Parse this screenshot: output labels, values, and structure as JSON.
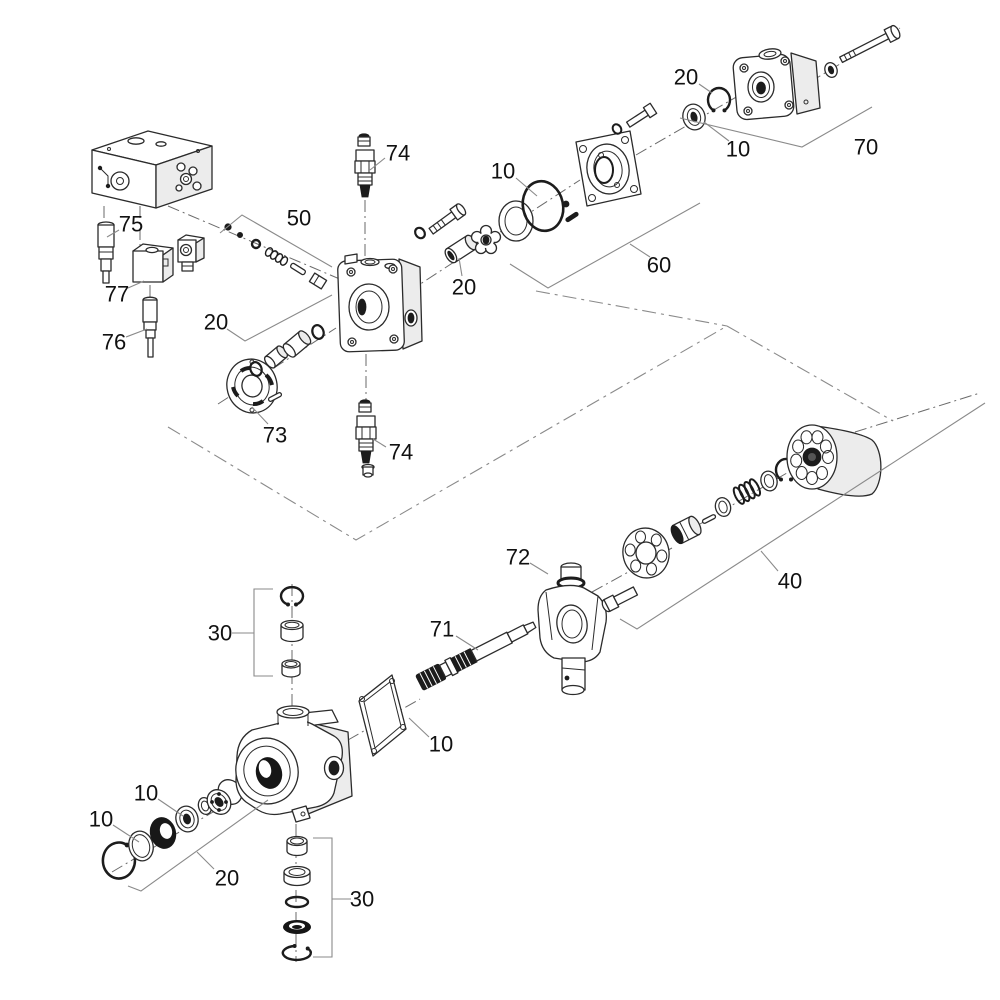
{
  "figure": {
    "type": "exploded-parts-diagram",
    "subject": "hydraulic-piston-pump-assembly",
    "background_color": "#ffffff",
    "line_color": "#2b2b2b",
    "label_color": "#111111",
    "callouts": [
      {
        "ref": "74",
        "x": 398,
        "y": 153,
        "leader": [
          [
            385,
            158
          ],
          [
            370,
            170
          ]
        ]
      },
      {
        "ref": "50",
        "x": 299,
        "y": 218,
        "bracket": [
          [
            220,
            233
          ],
          [
            242,
            215
          ],
          [
            332,
            267
          ]
        ]
      },
      {
        "ref": "75",
        "x": 131,
        "y": 224,
        "leader": [
          [
            119,
            230
          ],
          [
            107,
            237
          ]
        ]
      },
      {
        "ref": "77",
        "x": 117,
        "y": 294,
        "leader": [
          [
            128,
            288
          ],
          [
            144,
            281
          ]
        ]
      },
      {
        "ref": "76",
        "x": 114,
        "y": 342,
        "leader": [
          [
            126,
            337
          ],
          [
            147,
            329
          ]
        ]
      },
      {
        "ref": "20",
        "x": 216,
        "y": 322,
        "bracket": [
          [
            227,
            329
          ],
          [
            245,
            341
          ],
          [
            332,
            295
          ]
        ]
      },
      {
        "ref": "73",
        "x": 275,
        "y": 435,
        "leader": [
          [
            268,
            424
          ],
          [
            252,
            407
          ]
        ]
      },
      {
        "ref": "20",
        "x": 464,
        "y": 287,
        "leader": [
          [
            462,
            276
          ],
          [
            459,
            258
          ]
        ]
      },
      {
        "ref": "10",
        "x": 503,
        "y": 171,
        "leader": [
          [
            516,
            178
          ],
          [
            537,
            196
          ]
        ]
      },
      {
        "ref": "20",
        "x": 686,
        "y": 77,
        "leader": [
          [
            699,
            84
          ],
          [
            712,
            93
          ]
        ]
      },
      {
        "ref": "10",
        "x": 738,
        "y": 149,
        "leader": [
          [
            729,
            141
          ],
          [
            704,
            122
          ]
        ]
      },
      {
        "ref": "70",
        "x": 866,
        "y": 147,
        "bracket": [
          [
            680,
            118
          ],
          [
            802,
            147
          ],
          [
            872,
            107
          ]
        ]
      },
      {
        "ref": "60",
        "x": 659,
        "y": 265,
        "bracket": [
          [
            510,
            264
          ],
          [
            548,
            288
          ],
          [
            700,
            203
          ]
        ],
        "leader": [
          [
            650,
            257
          ],
          [
            630,
            244
          ]
        ]
      },
      {
        "ref": "74",
        "x": 401,
        "y": 452,
        "leader": [
          [
            386,
            447
          ],
          [
            373,
            439
          ]
        ]
      },
      {
        "ref": "72",
        "x": 518,
        "y": 557,
        "leader": [
          [
            530,
            563
          ],
          [
            548,
            574
          ]
        ]
      },
      {
        "ref": "71",
        "x": 442,
        "y": 629,
        "leader": [
          [
            456,
            636
          ],
          [
            478,
            650
          ]
        ]
      },
      {
        "ref": "40",
        "x": 790,
        "y": 581,
        "bracket": [
          [
            620,
            619
          ],
          [
            637,
            629
          ],
          [
            985,
            403
          ]
        ],
        "leader": [
          [
            778,
            571
          ],
          [
            761,
            551
          ]
        ]
      },
      {
        "ref": "10",
        "x": 441,
        "y": 744,
        "leader": [
          [
            429,
            737
          ],
          [
            409,
            718
          ]
        ]
      },
      {
        "ref": "30",
        "x": 220,
        "y": 633,
        "bracket": [
          [
            273,
            589
          ],
          [
            254,
            589
          ],
          [
            254,
            676
          ],
          [
            273,
            676
          ]
        ],
        "leader": [
          [
            232,
            633
          ],
          [
            254,
            633
          ]
        ]
      },
      {
        "ref": "10",
        "x": 146,
        "y": 793,
        "leader": [
          [
            158,
            799
          ],
          [
            183,
            816
          ]
        ]
      },
      {
        "ref": "10",
        "x": 101,
        "y": 819,
        "leader": [
          [
            113,
            825
          ],
          [
            139,
            842
          ]
        ]
      },
      {
        "ref": "20",
        "x": 227,
        "y": 878,
        "bracket": [
          [
            128,
            886
          ],
          [
            141,
            891
          ],
          [
            268,
            800
          ]
        ],
        "leader": [
          [
            214,
            869
          ],
          [
            197,
            852
          ]
        ]
      },
      {
        "ref": "30",
        "x": 362,
        "y": 899,
        "bracket": [
          [
            313,
            838
          ],
          [
            332,
            838
          ],
          [
            332,
            957
          ],
          [
            313,
            957
          ]
        ],
        "leader": [
          [
            332,
            899
          ],
          [
            351,
            899
          ]
        ]
      }
    ]
  }
}
